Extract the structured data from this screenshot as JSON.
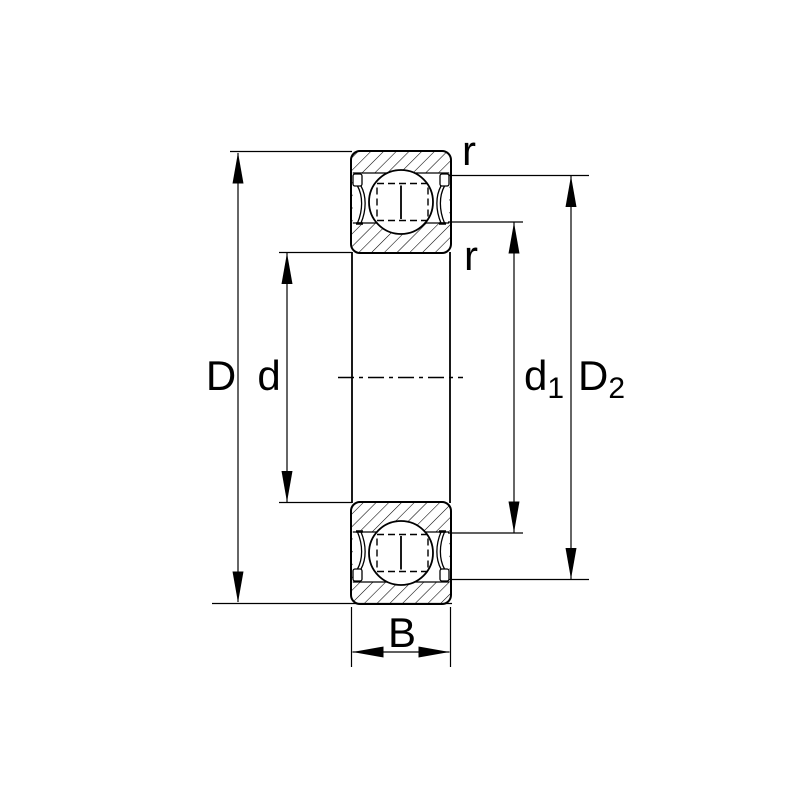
{
  "diagram": {
    "description": "Cross-section drawing of a shielded deep groove ball bearing with dimension annotations",
    "background_color": "#ffffff",
    "line_color": "#000000",
    "labels": {
      "D": "D",
      "d": "d",
      "d1_base": "d",
      "d1_sub": "1",
      "D2_base": "D",
      "D2_sub": "2",
      "B": "B",
      "r_outer": "r",
      "r_inner": "r"
    }
  }
}
